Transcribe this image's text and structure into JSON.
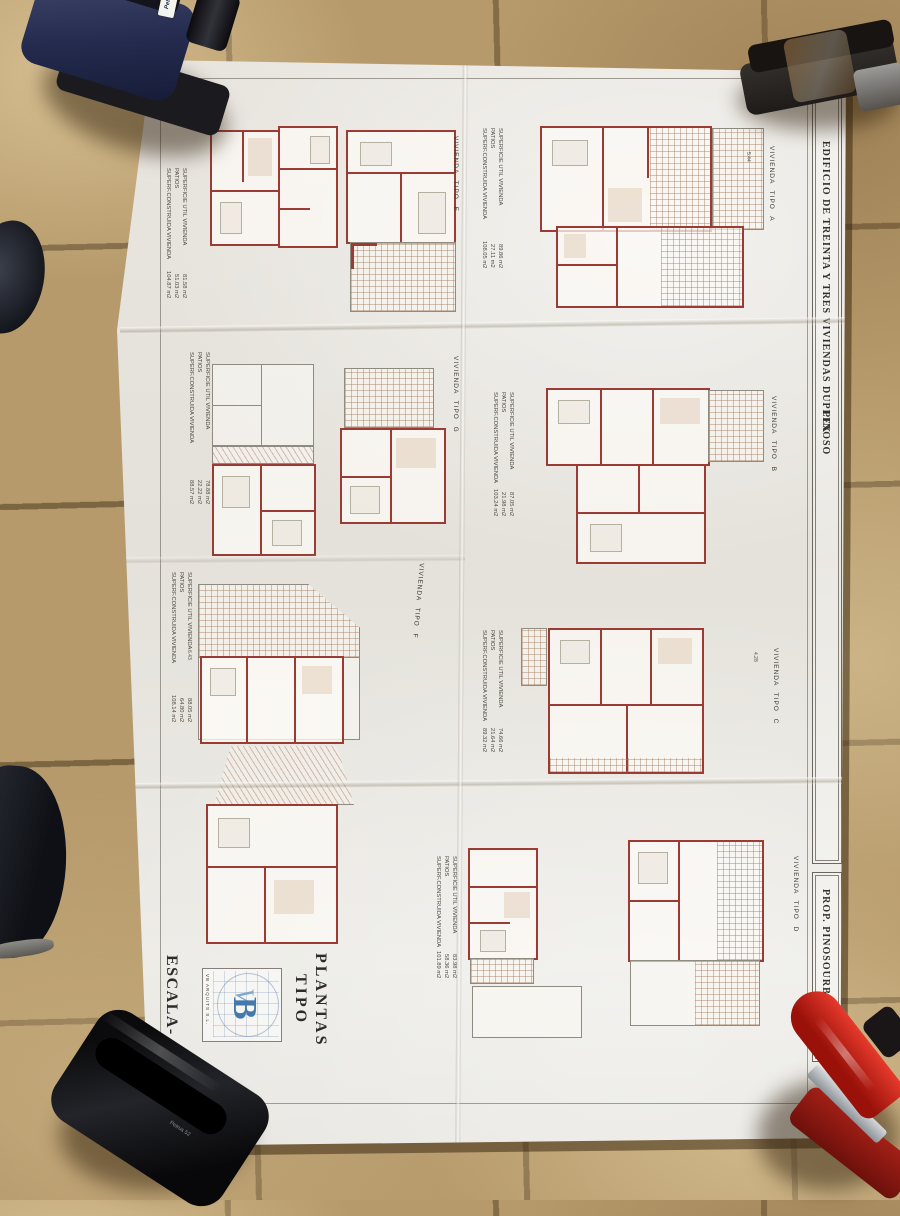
{
  "sheet": {
    "edge_title": "EDIFICIO DE TREINTA Y TRES VIVIENDAS DUPLEX",
    "edge_location": "PINOSO",
    "prop": "PROP.  PINOSOURBANA S.L.",
    "scale": "ESCALA- 1/100",
    "firm": "VB ARQUITS S.L.",
    "logo_v": "V",
    "logo_b": "B",
    "sheet_title_1": "PLANTAS",
    "sheet_title_2": "TIPO",
    "area_labels": {
      "util": "SUPERFICIE UTIL VIVIENDA",
      "patios": "PATIOS",
      "constr": "SUPERF.CONSTRUIDA VIVIENDA"
    },
    "units": {
      "a": "VIVIENDA TIPO A",
      "b": "VIVIENDA TIPO B",
      "c": "VIVIENDA TIPO C",
      "d": "VIVIENDA TIPO D",
      "e": "VIVIENDA TIPO E",
      "f": "VIVIENDA TIPO F",
      "g": "VIVIENDA TIPO G"
    },
    "area_blocks": [
      {
        "util": "81.58 m2",
        "patios": "51.03 m2",
        "constr": "104.87 m2"
      },
      {
        "util": "89.86 m2",
        "patios": "27.11 m2",
        "constr": "108.05 m2"
      },
      {
        "util": "78.88 m2",
        "patios": "22.22 m2",
        "constr": "88.57 m2"
      },
      {
        "util": "87.05 m2",
        "patios": "21.98 m2",
        "constr": "103.24 m2"
      },
      {
        "util": "88.05 m2",
        "patios": "64.80 m2",
        "constr": "108.14 m2"
      },
      {
        "util": "74.66 m2",
        "patios": "21.64 m2",
        "constr": "89.32 m2"
      },
      {
        "util": "83.98 m2",
        "patios": "58.36 m2",
        "constr": "101.89 m2"
      }
    ],
    "dims": {
      "a": "5.44",
      "c": "4.28",
      "f": "6.43"
    }
  },
  "objects": {
    "blue_punch_brand": "Petrus",
    "black_punch_brand": "Petrus 52"
  }
}
